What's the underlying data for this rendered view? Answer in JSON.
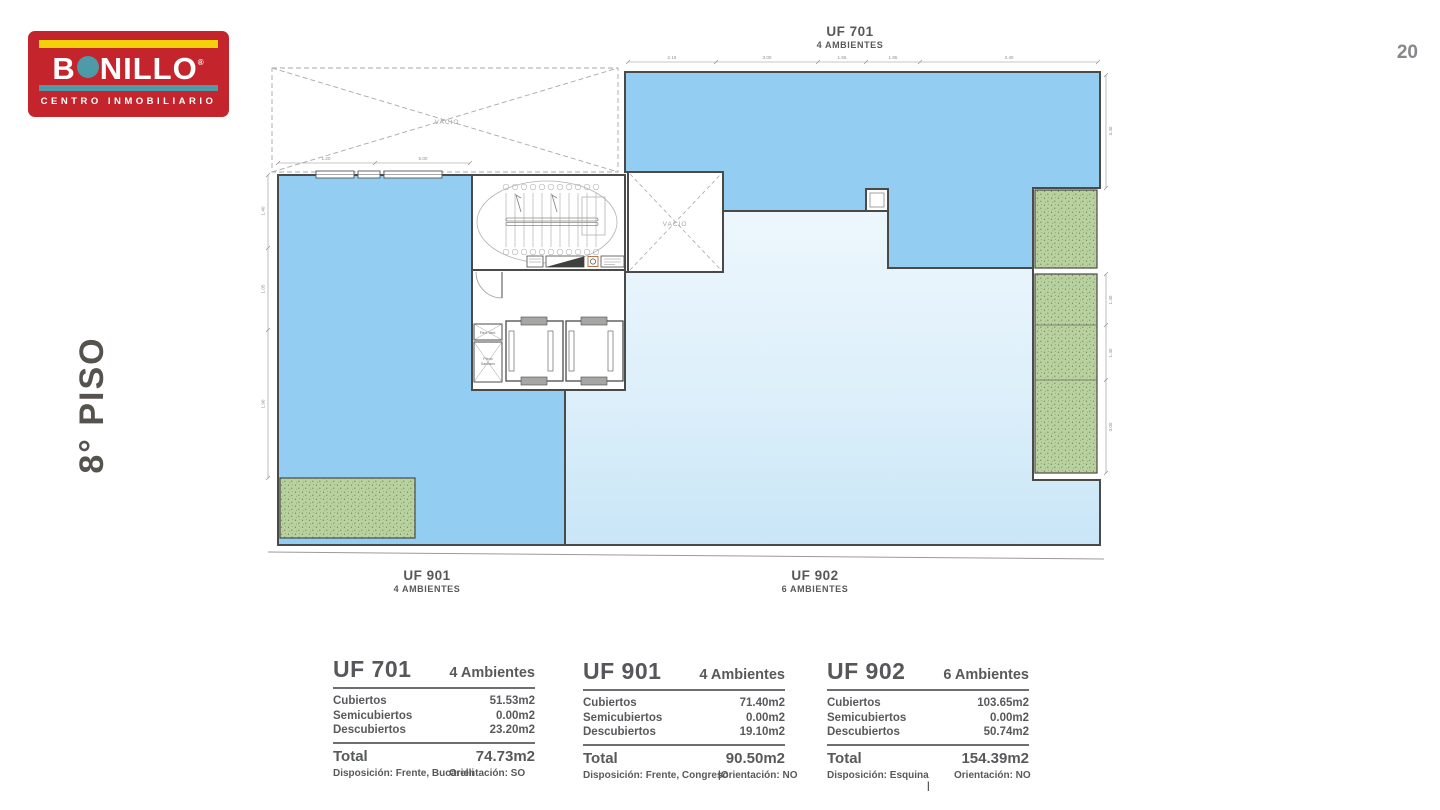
{
  "page": {
    "number": "20",
    "floor_label": "8° PISO"
  },
  "logo": {
    "word_b": "B",
    "word_rest": "NILLO",
    "registered": "®",
    "tagline": "CENTRO INMOBILIARIO"
  },
  "colors": {
    "logo_red": "#c4242c",
    "logo_yellow": "#f4d10a",
    "logo_teal": "#4d9aa8",
    "unit_fill_dark": "#93cdf1",
    "unit_fill_light": "#ddeffa",
    "terrace_green": "#b9d09f",
    "wall": "#4a4a48",
    "text_gray": "#58595b"
  },
  "plan": {
    "void_label": "VACIO",
    "units": [
      {
        "id": "UF 701",
        "ambientes": "4 AMBIENTES"
      },
      {
        "id": "UF 901",
        "ambientes": "4 AMBIENTES"
      },
      {
        "id": "UF 902",
        "ambientes": "6 AMBIENTES"
      }
    ],
    "core": {
      "vent_label": "Plen. Vent.",
      "san_line1": "Pleno",
      "san_line2": "Sanitario"
    },
    "dims": {
      "top": [
        "2.15",
        "3.00",
        "1.55",
        "1.85",
        "3.40"
      ],
      "top_left": [
        "1.20",
        "5.00"
      ],
      "left": [
        "1.40",
        "1.05",
        "1.90"
      ],
      "right": [
        "3.40",
        "1.40",
        "1.40",
        "3.00"
      ]
    }
  },
  "tables": [
    {
      "unit": "UF 701",
      "ambientes": "4 Ambientes",
      "rows": [
        {
          "label": "Cubiertos",
          "value": "51.53m2"
        },
        {
          "label": "Semicubiertos",
          "value": "0.00m2"
        },
        {
          "label": "Descubiertos",
          "value": "23.20m2"
        }
      ],
      "total_label": "Total",
      "total": "74.73m2",
      "disposicion": "Disposición: Frente, Bucarelli",
      "orientacion": "Orientación: SO"
    },
    {
      "unit": "UF 901",
      "ambientes": "4 Ambientes",
      "rows": [
        {
          "label": "Cubiertos",
          "value": "71.40m2"
        },
        {
          "label": "Semicubiertos",
          "value": "0.00m2"
        },
        {
          "label": "Descubiertos",
          "value": "19.10m2"
        }
      ],
      "total_label": "Total",
      "total": "90.50m2",
      "disposicion": "Disposición: Frente, Congreso",
      "orientacion": "|Orientación: NO"
    },
    {
      "unit": "UF 902",
      "ambientes": "6 Ambientes",
      "rows": [
        {
          "label": "Cubiertos",
          "value": "103.65m2"
        },
        {
          "label": "Semicubiertos",
          "value": "0.00m2"
        },
        {
          "label": "Descubiertos",
          "value": "50.74m2"
        }
      ],
      "total_label": "Total",
      "total": "154.39m2",
      "disposicion": "Disposición: Esquina",
      "orientacion": "Orientación: NO",
      "separator": "|"
    }
  ]
}
